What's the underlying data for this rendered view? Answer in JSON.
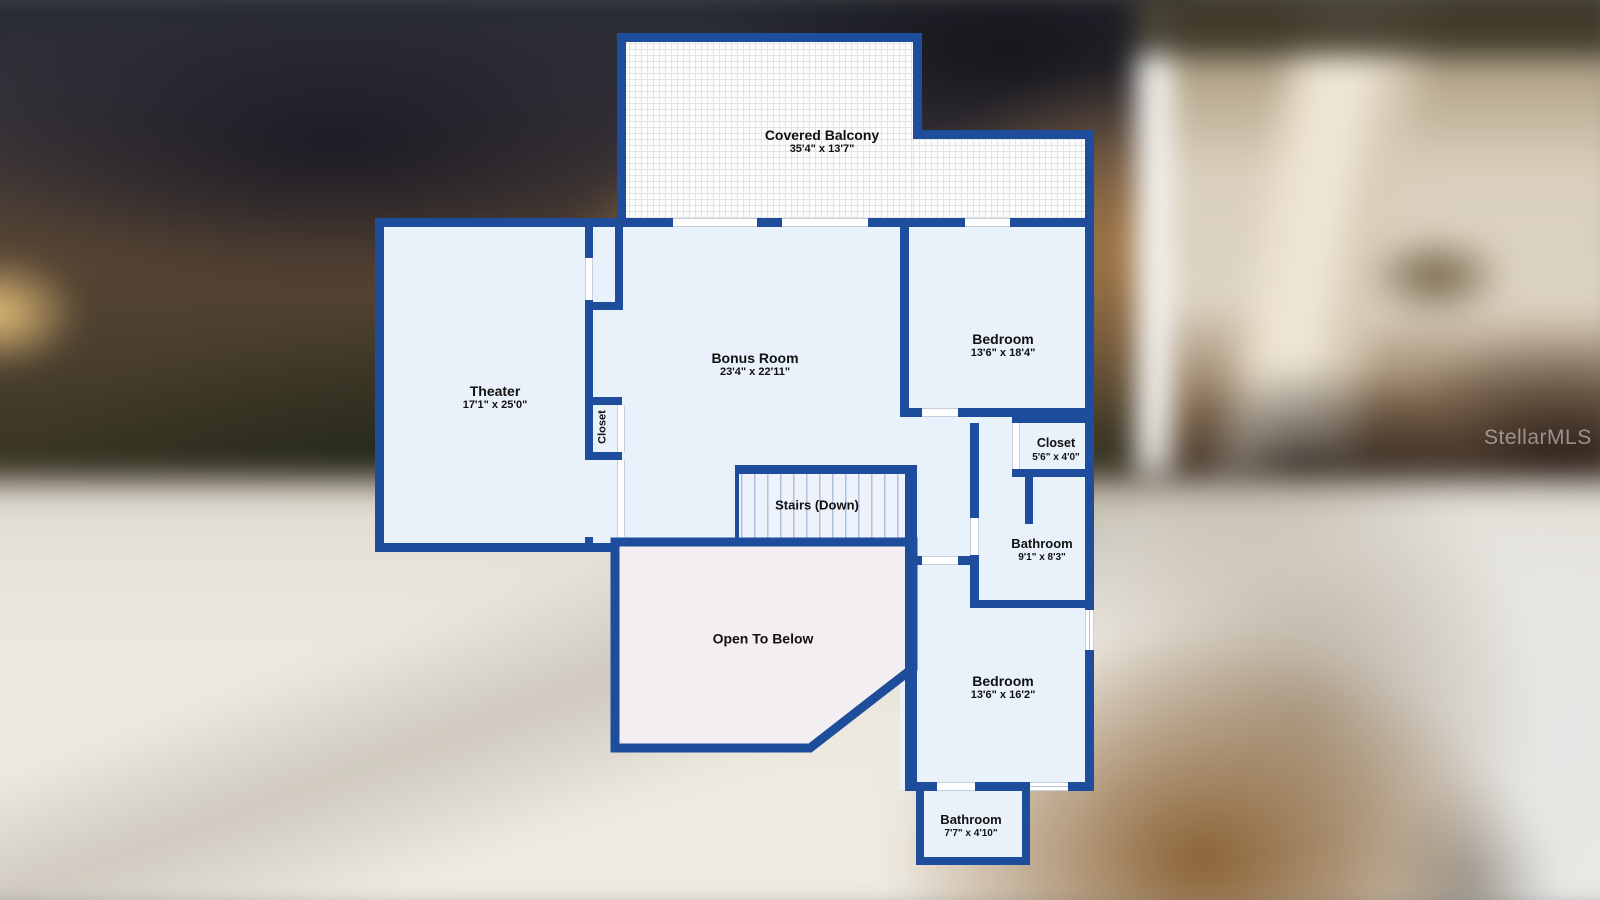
{
  "watermark": "StellarMLS",
  "colors": {
    "wall": "#1e4d9b",
    "room_fill": "#e9f1fb",
    "open_below_fill": "#f3eef2",
    "stairs_fill": "#eef3fb",
    "label": "#111111"
  },
  "rooms": {
    "covered_balcony": {
      "label": "Covered Balcony",
      "dims": "35'4\" x 13'7\""
    },
    "theater": {
      "label": "Theater",
      "dims": "17'1\" x 25'0\""
    },
    "closet_theater": {
      "label": "Closet"
    },
    "bonus_room": {
      "label": "Bonus Room",
      "dims": "23'4\" x 22'11\""
    },
    "bedroom_upper": {
      "label": "Bedroom",
      "dims": "13'6\" x 18'4\""
    },
    "closet_upper": {
      "label": "Closet",
      "dims": "5'6\" x 4'0\""
    },
    "bathroom_upper": {
      "label": "Bathroom",
      "dims": "9'1\" x 8'3\""
    },
    "stairs": {
      "label": "Stairs (Down)"
    },
    "open_to_below": {
      "label": "Open To Below"
    },
    "bedroom_lower": {
      "label": "Bedroom",
      "dims": "13'6\" x 16'2\""
    },
    "bathroom_lower": {
      "label": "Bathroom",
      "dims": "7'7\" x 4'10\""
    }
  }
}
